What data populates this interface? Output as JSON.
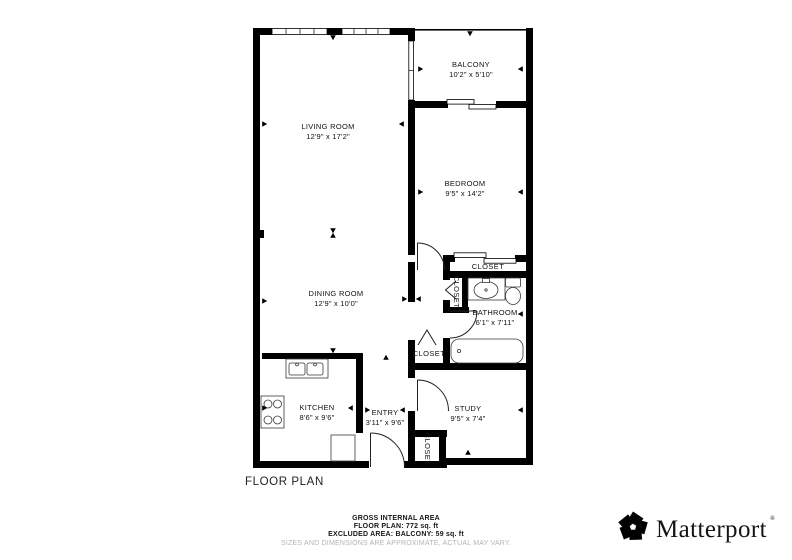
{
  "plan": {
    "title": "FLOOR PLAN",
    "rooms": {
      "balcony": {
        "name": "BALCONY",
        "dims": "10'2\" x 5'10\""
      },
      "living": {
        "name": "LIVING ROOM",
        "dims": "12'9\" x 17'2\""
      },
      "bedroom": {
        "name": "BEDROOM",
        "dims": "9'5\" x 14'2\""
      },
      "dining": {
        "name": "DINING ROOM",
        "dims": "12'9\" x 10'0\""
      },
      "bathroom": {
        "name": "BATHROOM",
        "dims": "6'1\" x 7'11\""
      },
      "kitchen": {
        "name": "KITCHEN",
        "dims": "8'6\" x 9'6\""
      },
      "entry": {
        "name": "ENTRY",
        "dims": "3'11\" x 9'6\""
      },
      "study": {
        "name": "STUDY",
        "dims": "9'5\" x 7'4\""
      },
      "closet_bedroom": "CLOSET",
      "closet_linen": "CLOSET",
      "closet_hall": "CLOSET",
      "closet_entry": "CLOSET"
    }
  },
  "footer": {
    "area_heading": "GROSS INTERNAL AREA",
    "area_floor_plan": "FLOOR PLAN: 772 sq. ft",
    "area_excluded": "EXCLUDED AREA: BALCONY: 59 sq. ft",
    "disclaimer": "SIZES AND DIMENSIONS ARE APPROXIMATE, ACTUAL MAY VARY."
  },
  "brand": {
    "name": "Matterport",
    "mark": "®"
  },
  "colors": {
    "wall": "#000000",
    "text": "#121212",
    "disclaimer": "#b4b4b4"
  }
}
